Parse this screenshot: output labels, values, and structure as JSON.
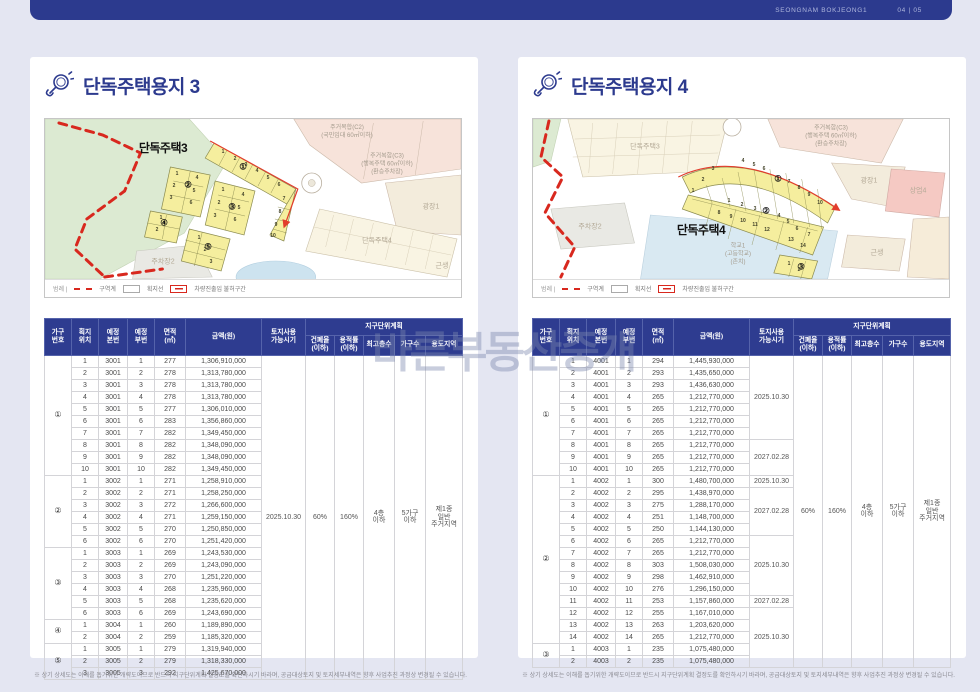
{
  "page": {
    "header": {
      "brand": "SEONGNAM BOKJEONG1",
      "page_no": "04 | 05"
    },
    "watermark": "바른부동산중개",
    "footnote": "※ 상기 상세도는 이해를 돕기위한 개략도이므로 반드시 지구단위계획 결정도를 확인하시기 바라며, 공급대상토지 및 토지세부내역은 향후 사업추진 과정상 변경될 수 있습니다."
  },
  "colors": {
    "navy": "#2c3a8e",
    "red": "#d8281e",
    "parcel_yellow": "#f5ee9e",
    "page_bg": "#e4e6f2"
  },
  "legend": {
    "label": "범례 |",
    "items": [
      {
        "name": "구역계",
        "style": "red-dash"
      },
      {
        "name": "획지선",
        "style": "gray-box"
      },
      {
        "name": "차량진출입 불허구간",
        "style": "red-box"
      }
    ]
  },
  "table_headers": {
    "cols": [
      "가구\n번호",
      "획지\n위치",
      "예정\n본번",
      "예정\n부번",
      "면적\n(㎡)",
      "금액(원)",
      "토지사용\n가능시기"
    ],
    "group": "지구단위계획",
    "group_cols": [
      "건폐율\n(이하)",
      "용적률\n(이하)",
      "최고층수",
      "가구수",
      "용도지역"
    ]
  },
  "left": {
    "title": "단독주택용지 3",
    "map": {
      "labels": [
        {
          "text": "단독주택3",
          "x": 118,
          "y": 30,
          "cls": "bold",
          "name": "area-label-danok3"
        },
        {
          "text": "주거복합(C2)\n(국민임대 60㎡이하)",
          "x": 302,
          "y": 14,
          "cls": "",
          "name": "area-label-c2"
        },
        {
          "text": "주거복합(C3)\n(행복주택 60㎡이하)\n(환승주차장)",
          "x": 342,
          "y": 46,
          "cls": "",
          "name": "area-label-c3"
        },
        {
          "text": "광장1",
          "x": 386,
          "y": 88,
          "cls": "faint",
          "name": "area-label-plaza1"
        },
        {
          "text": "단독주택4",
          "x": 332,
          "y": 122,
          "cls": "faint",
          "name": "area-label-danok4"
        },
        {
          "text": "근생",
          "x": 397,
          "y": 147,
          "cls": "faint",
          "name": "area-label-geunsaeng"
        },
        {
          "text": "주차장2",
          "x": 118,
          "y": 143,
          "cls": "faint",
          "name": "area-label-parking2"
        },
        {
          "text": "①",
          "x": 198,
          "y": 48,
          "cls": "circ",
          "name": "block-number-circle"
        },
        {
          "text": "②",
          "x": 143,
          "y": 66,
          "cls": "circ",
          "name": "block-number-circle"
        },
        {
          "text": "③",
          "x": 187,
          "y": 88,
          "cls": "circ",
          "name": "block-number-circle"
        },
        {
          "text": "④",
          "x": 119,
          "y": 104,
          "cls": "circ",
          "name": "block-number-circle"
        },
        {
          "text": "⑤",
          "x": 163,
          "y": 128,
          "cls": "circ",
          "name": "block-number-circle"
        },
        {
          "text": "1",
          "x": 178,
          "y": 33,
          "cls": "num"
        },
        {
          "text": "2",
          "x": 190,
          "y": 40,
          "cls": "num"
        },
        {
          "text": "3",
          "x": 201,
          "y": 46,
          "cls": "num"
        },
        {
          "text": "4",
          "x": 212,
          "y": 52,
          "cls": "num"
        },
        {
          "text": "5",
          "x": 223,
          "y": 59,
          "cls": "num"
        },
        {
          "text": "6",
          "x": 234,
          "y": 66,
          "cls": "num"
        },
        {
          "text": "7",
          "x": 239,
          "y": 80,
          "cls": "num"
        },
        {
          "text": "8",
          "x": 235,
          "y": 93,
          "cls": "num"
        },
        {
          "text": "9",
          "x": 231,
          "y": 106,
          "cls": "num"
        },
        {
          "text": "10",
          "x": 228,
          "y": 117,
          "cls": "num"
        },
        {
          "text": "1",
          "x": 132,
          "y": 55,
          "cls": "num"
        },
        {
          "text": "4",
          "x": 152,
          "y": 59,
          "cls": "num"
        },
        {
          "text": "2",
          "x": 129,
          "y": 67,
          "cls": "num"
        },
        {
          "text": "5",
          "x": 149,
          "y": 72,
          "cls": "num"
        },
        {
          "text": "3",
          "x": 126,
          "y": 79,
          "cls": "num"
        },
        {
          "text": "6",
          "x": 146,
          "y": 84,
          "cls": "num"
        },
        {
          "text": "1",
          "x": 178,
          "y": 71,
          "cls": "num"
        },
        {
          "text": "4",
          "x": 198,
          "y": 76,
          "cls": "num"
        },
        {
          "text": "2",
          "x": 174,
          "y": 84,
          "cls": "num"
        },
        {
          "text": "5",
          "x": 194,
          "y": 89,
          "cls": "num"
        },
        {
          "text": "3",
          "x": 170,
          "y": 97,
          "cls": "num"
        },
        {
          "text": "6",
          "x": 190,
          "y": 101,
          "cls": "num"
        },
        {
          "text": "1",
          "x": 116,
          "y": 99,
          "cls": "num"
        },
        {
          "text": "2",
          "x": 112,
          "y": 111,
          "cls": "num"
        },
        {
          "text": "1",
          "x": 154,
          "y": 119,
          "cls": "num"
        },
        {
          "text": "2",
          "x": 160,
          "y": 131,
          "cls": "num"
        },
        {
          "text": "3",
          "x": 166,
          "y": 143,
          "cls": "num"
        }
      ]
    },
    "table": {
      "groups": [
        {
          "no": "①",
          "rows": [
            [
              "1",
              "3001",
              "1",
              "277",
              "1,306,910,000"
            ],
            [
              "2",
              "3001",
              "2",
              "278",
              "1,313,780,000"
            ],
            [
              "3",
              "3001",
              "3",
              "278",
              "1,313,780,000"
            ],
            [
              "4",
              "3001",
              "4",
              "278",
              "1,313,780,000"
            ],
            [
              "5",
              "3001",
              "5",
              "277",
              "1,306,010,000"
            ],
            [
              "6",
              "3001",
              "6",
              "283",
              "1,356,860,000"
            ],
            [
              "7",
              "3001",
              "7",
              "282",
              "1,349,450,000"
            ],
            [
              "8",
              "3001",
              "8",
              "282",
              "1,348,090,000"
            ],
            [
              "9",
              "3001",
              "9",
              "282",
              "1,348,090,000"
            ],
            [
              "10",
              "3001",
              "10",
              "282",
              "1,349,450,000"
            ]
          ]
        },
        {
          "no": "②",
          "rows": [
            [
              "1",
              "3002",
              "1",
              "271",
              "1,258,910,000"
            ],
            [
              "2",
              "3002",
              "2",
              "271",
              "1,258,250,000"
            ],
            [
              "3",
              "3002",
              "3",
              "272",
              "1,266,600,000"
            ],
            [
              "4",
              "3002",
              "4",
              "271",
              "1,259,150,000"
            ],
            [
              "5",
              "3002",
              "5",
              "270",
              "1,250,850,000"
            ],
            [
              "6",
              "3002",
              "6",
              "270",
              "1,251,420,000"
            ]
          ]
        },
        {
          "no": "③",
          "rows": [
            [
              "1",
              "3003",
              "1",
              "269",
              "1,243,530,000"
            ],
            [
              "2",
              "3003",
              "2",
              "269",
              "1,243,090,000"
            ],
            [
              "3",
              "3003",
              "3",
              "270",
              "1,251,220,000"
            ],
            [
              "4",
              "3003",
              "4",
              "268",
              "1,235,960,000"
            ],
            [
              "5",
              "3003",
              "5",
              "268",
              "1,235,620,000"
            ],
            [
              "6",
              "3003",
              "6",
              "269",
              "1,243,690,000"
            ]
          ]
        },
        {
          "no": "④",
          "rows": [
            [
              "1",
              "3004",
              "1",
              "260",
              "1,189,890,000"
            ],
            [
              "2",
              "3004",
              "2",
              "259",
              "1,185,320,000"
            ]
          ]
        },
        {
          "no": "⑤",
          "rows": [
            [
              "1",
              "3005",
              "1",
              "279",
              "1,319,940,000"
            ],
            [
              "2",
              "3005",
              "2",
              "279",
              "1,318,330,000"
            ],
            [
              "3",
              "3005",
              "3",
              "292",
              "1,425,670,000"
            ]
          ]
        }
      ],
      "date_segments": [
        {
          "t": "2025.10.30",
          "s": 27
        }
      ],
      "district": {
        "coverage": "60%",
        "far": "160%",
        "floors": "4층\n이하",
        "households": "5가구\n이하",
        "zone": "제1종\n일반\n주거지역"
      }
    }
  },
  "right": {
    "title": "단독주택용지 4",
    "map": {
      "labels": [
        {
          "text": "단독주택4",
          "x": 168,
          "y": 112,
          "cls": "bold",
          "name": "area-label-danok4"
        },
        {
          "text": "단독주택3",
          "x": 112,
          "y": 28,
          "cls": "faint",
          "name": "area-label-danok3"
        },
        {
          "text": "주거복합(C3)\n(행복주택 60㎡이하)\n(환승주차장)",
          "x": 298,
          "y": 18,
          "cls": "",
          "name": "area-label-c3"
        },
        {
          "text": "광장1",
          "x": 336,
          "y": 62,
          "cls": "faint",
          "name": "area-label-plaza1"
        },
        {
          "text": "상업4",
          "x": 385,
          "y": 72,
          "cls": "faint",
          "name": "area-label-sangup4"
        },
        {
          "text": "주차장2",
          "x": 57,
          "y": 108,
          "cls": "faint",
          "name": "area-label-parking2"
        },
        {
          "text": "학교1\n(고등학교)\n(존치)",
          "x": 205,
          "y": 136,
          "cls": "",
          "name": "area-label-school1"
        },
        {
          "text": "근생",
          "x": 344,
          "y": 134,
          "cls": "faint",
          "name": "area-label-geunsaeng"
        },
        {
          "text": "①",
          "x": 245,
          "y": 60,
          "cls": "circ",
          "name": "block-number-circle"
        },
        {
          "text": "②",
          "x": 233,
          "y": 92,
          "cls": "circ",
          "name": "block-number-circle"
        },
        {
          "text": "③",
          "x": 268,
          "y": 148,
          "cls": "circ",
          "name": "block-number-circle"
        },
        {
          "text": "3",
          "x": 180,
          "y": 50,
          "cls": "num"
        },
        {
          "text": "2",
          "x": 170,
          "y": 61,
          "cls": "num"
        },
        {
          "text": "1",
          "x": 160,
          "y": 72,
          "cls": "num"
        },
        {
          "text": "4",
          "x": 210,
          "y": 42,
          "cls": "num"
        },
        {
          "text": "5",
          "x": 221,
          "y": 46,
          "cls": "num"
        },
        {
          "text": "6",
          "x": 231,
          "y": 50,
          "cls": "num"
        },
        {
          "text": "7",
          "x": 256,
          "y": 63,
          "cls": "num"
        },
        {
          "text": "8",
          "x": 266,
          "y": 69,
          "cls": "num"
        },
        {
          "text": "9",
          "x": 276,
          "y": 76,
          "cls": "num"
        },
        {
          "text": "10",
          "x": 287,
          "y": 84,
          "cls": "num"
        },
        {
          "text": "1",
          "x": 196,
          "y": 82,
          "cls": "num"
        },
        {
          "text": "2",
          "x": 209,
          "y": 86,
          "cls": "num"
        },
        {
          "text": "3",
          "x": 222,
          "y": 90,
          "cls": "num"
        },
        {
          "text": "4",
          "x": 246,
          "y": 97,
          "cls": "num"
        },
        {
          "text": "5",
          "x": 255,
          "y": 103,
          "cls": "num"
        },
        {
          "text": "8",
          "x": 186,
          "y": 94,
          "cls": "num"
        },
        {
          "text": "9",
          "x": 198,
          "y": 98,
          "cls": "num"
        },
        {
          "text": "10",
          "x": 210,
          "y": 102,
          "cls": "num"
        },
        {
          "text": "11",
          "x": 222,
          "y": 106,
          "cls": "num"
        },
        {
          "text": "12",
          "x": 234,
          "y": 111,
          "cls": "num"
        },
        {
          "text": "6",
          "x": 264,
          "y": 110,
          "cls": "num"
        },
        {
          "text": "7",
          "x": 276,
          "y": 116,
          "cls": "num"
        },
        {
          "text": "13",
          "x": 258,
          "y": 121,
          "cls": "num"
        },
        {
          "text": "14",
          "x": 270,
          "y": 127,
          "cls": "num"
        },
        {
          "text": "1",
          "x": 256,
          "y": 145,
          "cls": "num"
        },
        {
          "text": "2",
          "x": 266,
          "y": 151,
          "cls": "num"
        }
      ]
    },
    "table": {
      "groups": [
        {
          "no": "①",
          "rows": [
            [
              "1",
              "4001",
              "1",
              "294",
              "1,445,930,000"
            ],
            [
              "2",
              "4001",
              "2",
              "293",
              "1,435,650,000"
            ],
            [
              "3",
              "4001",
              "3",
              "293",
              "1,436,630,000"
            ],
            [
              "4",
              "4001",
              "4",
              "265",
              "1,212,770,000"
            ],
            [
              "5",
              "4001",
              "5",
              "265",
              "1,212,770,000"
            ],
            [
              "6",
              "4001",
              "6",
              "265",
              "1,212,770,000"
            ],
            [
              "7",
              "4001",
              "7",
              "265",
              "1,212,770,000"
            ],
            [
              "8",
              "4001",
              "8",
              "265",
              "1,212,770,000"
            ],
            [
              "9",
              "4001",
              "9",
              "265",
              "1,212,770,000"
            ],
            [
              "10",
              "4001",
              "10",
              "265",
              "1,212,770,000"
            ]
          ]
        },
        {
          "no": "②",
          "rows": [
            [
              "1",
              "4002",
              "1",
              "300",
              "1,480,700,000"
            ],
            [
              "2",
              "4002",
              "2",
              "295",
              "1,438,970,000"
            ],
            [
              "3",
              "4002",
              "3",
              "275",
              "1,288,170,000"
            ],
            [
              "4",
              "4002",
              "4",
              "251",
              "1,148,700,000"
            ],
            [
              "5",
              "4002",
              "5",
              "250",
              "1,144,130,000"
            ],
            [
              "6",
              "4002",
              "6",
              "265",
              "1,212,770,000"
            ],
            [
              "7",
              "4002",
              "7",
              "265",
              "1,212,770,000"
            ],
            [
              "8",
              "4002",
              "8",
              "303",
              "1,508,030,000"
            ],
            [
              "9",
              "4002",
              "9",
              "298",
              "1,462,910,000"
            ],
            [
              "10",
              "4002",
              "10",
              "276",
              "1,296,150,000"
            ],
            [
              "11",
              "4002",
              "11",
              "253",
              "1,157,860,000"
            ],
            [
              "12",
              "4002",
              "12",
              "255",
              "1,167,010,000"
            ],
            [
              "13",
              "4002",
              "13",
              "263",
              "1,203,620,000"
            ],
            [
              "14",
              "4002",
              "14",
              "265",
              "1,212,770,000"
            ]
          ]
        },
        {
          "no": "③",
          "rows": [
            [
              "1",
              "4003",
              "1",
              "235",
              "1,075,480,000"
            ],
            [
              "2",
              "4003",
              "2",
              "235",
              "1,075,480,000"
            ]
          ]
        }
      ],
      "date_segments": [
        {
          "t": "2025.10.30",
          "s": 7
        },
        {
          "t": "2027.02.28",
          "s": 3
        },
        {
          "t": "2025.10.30",
          "s": 1
        },
        {
          "t": "2027.02.28",
          "s": 4
        },
        {
          "t": "2025.10.30",
          "s": 5
        },
        {
          "t": "2027.02.28",
          "s": 1
        },
        {
          "t": "2025.10.30",
          "s": 5
        }
      ],
      "district": {
        "coverage": "60%",
        "far": "160%",
        "floors": "4층\n이하",
        "households": "5가구\n이하",
        "zone": "제1종\n일반\n주거지역"
      }
    }
  }
}
